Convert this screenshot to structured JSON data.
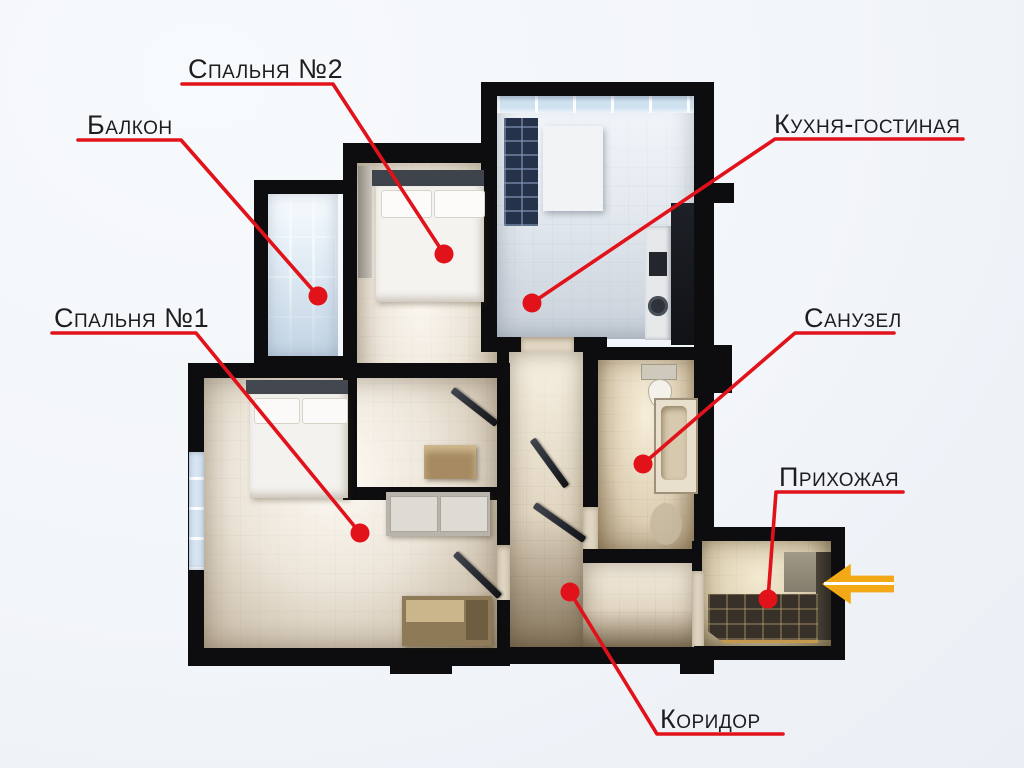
{
  "scene": {
    "background": "#f2f5f9",
    "wall_color": "#0d0d0f",
    "accent_red": "#e2121a",
    "label_color": "#1d1d1f"
  },
  "callouts": [
    {
      "id": "bedroom2",
      "label": "Спальня №2",
      "line": "182,84 333,84 444,254",
      "dot": {
        "x": 444,
        "y": 254
      }
    },
    {
      "id": "balcony",
      "label": "Балкон",
      "line": "78,140 181,140 318,296",
      "dot": {
        "x": 318,
        "y": 296
      }
    },
    {
      "id": "kitchen",
      "label": "Кухня-гостиная",
      "line": "963,139 775,139 532,303",
      "dot": {
        "x": 532,
        "y": 303
      }
    },
    {
      "id": "bedroom1",
      "label": "Спальня №1",
      "line": "52,333 196,333 360,533",
      "dot": {
        "x": 360,
        "y": 533
      }
    },
    {
      "id": "bathroom",
      "label": "Санузел",
      "line": "894,333 795,333 643,464",
      "dot": {
        "x": 643,
        "y": 464
      }
    },
    {
      "id": "hallway",
      "label": "Прихожая",
      "line": "903,492 776,492 768,599",
      "dot": {
        "x": 768,
        "y": 599
      }
    },
    {
      "id": "corridor",
      "label": "Коридор",
      "line": "783,734 657,734 570,592",
      "dot": {
        "x": 570,
        "y": 592
      }
    }
  ],
  "entry_arrow": {
    "color": "#f2a915",
    "stripe_color": "#ffffff",
    "direction": "left"
  }
}
